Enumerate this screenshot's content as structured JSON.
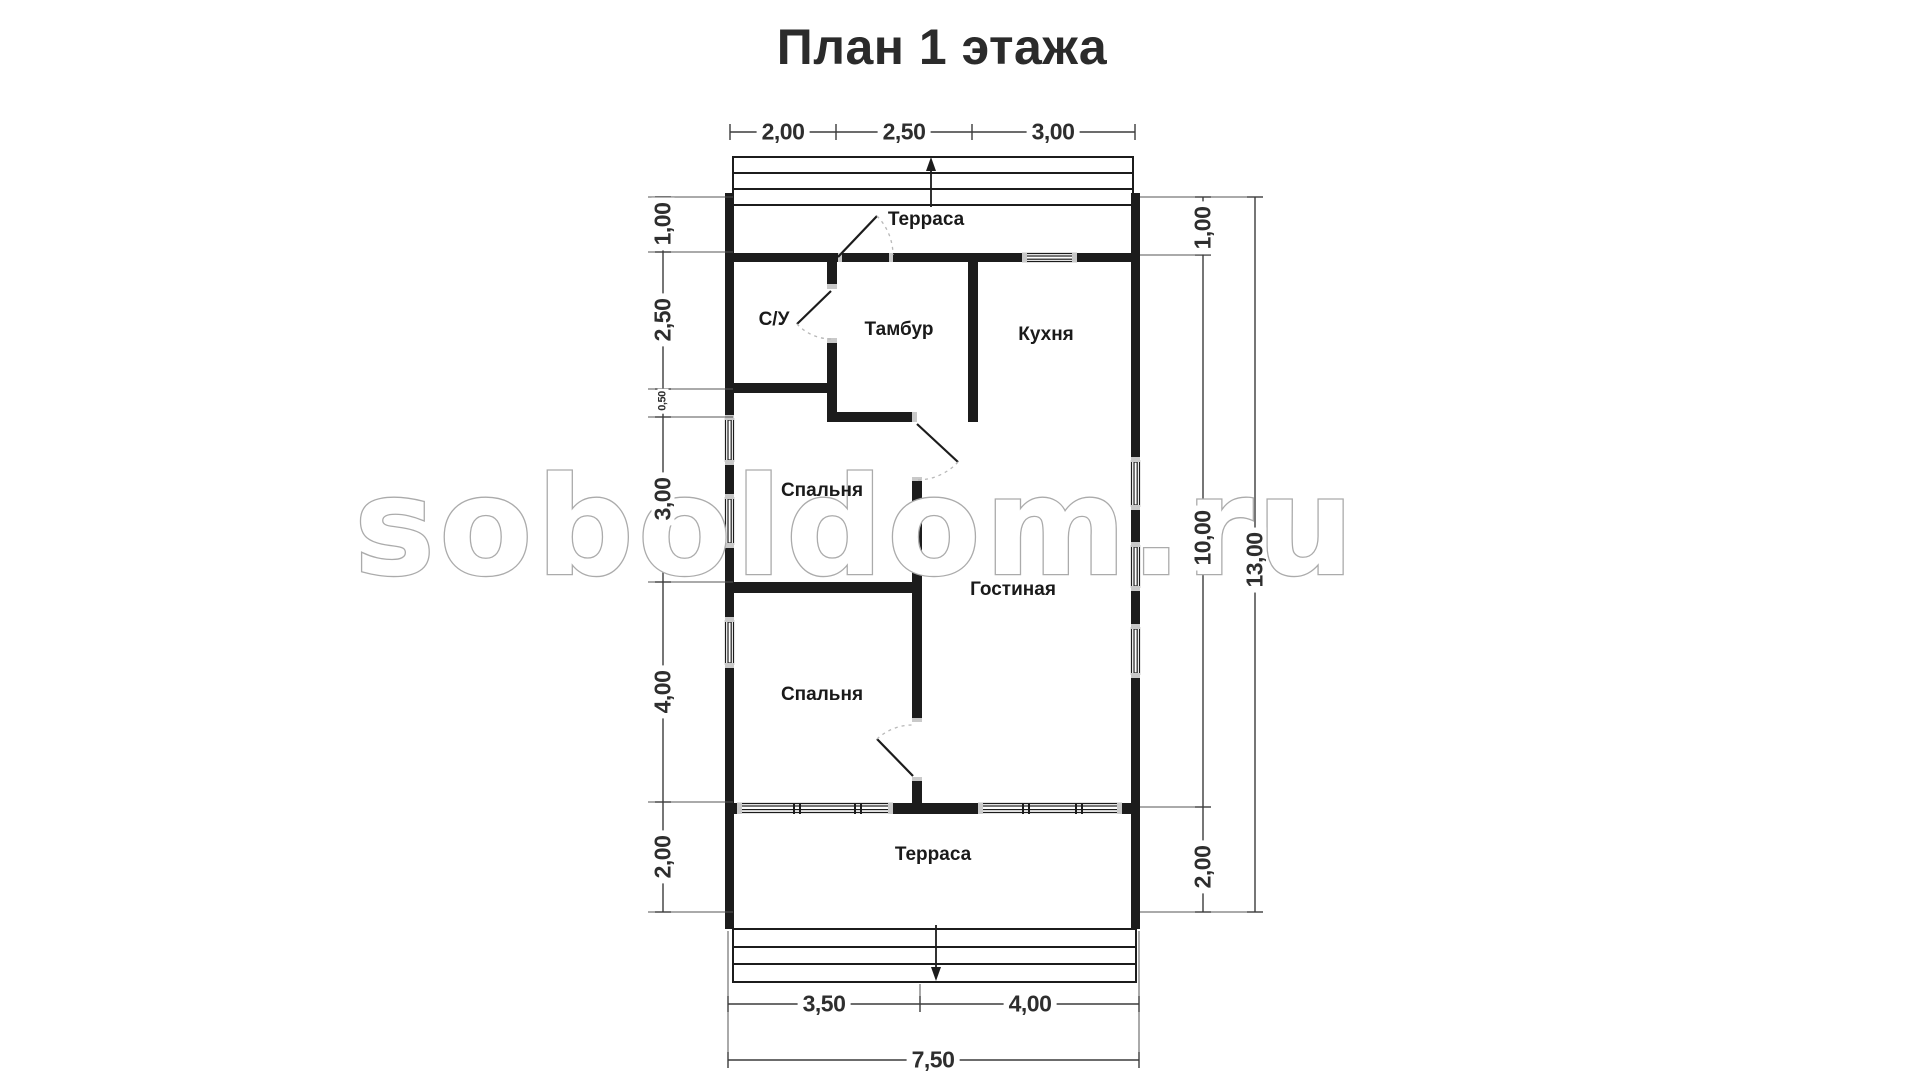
{
  "title": "План 1 этажа",
  "watermark": "soboldom.ru",
  "rooms": {
    "terrace_top": "Терраса",
    "bathroom": "С/У",
    "vestibule": "Тамбур",
    "kitchen": "Кухня",
    "bedroom_1": "Спальня",
    "living_room": "Гостиная",
    "bedroom_2": "Спальня",
    "terrace_bottom": "Терраса"
  },
  "dimensions": {
    "top": [
      "2,00",
      "2,50",
      "3,00"
    ],
    "left": [
      "1,00",
      "2,50",
      "0,50",
      "3,00",
      "4,00",
      "2,00"
    ],
    "right": [
      "1,00",
      "10,00",
      "2,00"
    ],
    "right_total": "13,00",
    "bottom": [
      "3,50",
      "4,00"
    ],
    "bottom_total": "7,50"
  },
  "colors": {
    "wall": "#1c1c1c",
    "dimension_line": "#3c3c3c",
    "window_cap": "#c9c9c9",
    "door_arc": "#b8b8b8",
    "watermark_outline": "#ababab",
    "title_text": "#2b2b2b"
  }
}
